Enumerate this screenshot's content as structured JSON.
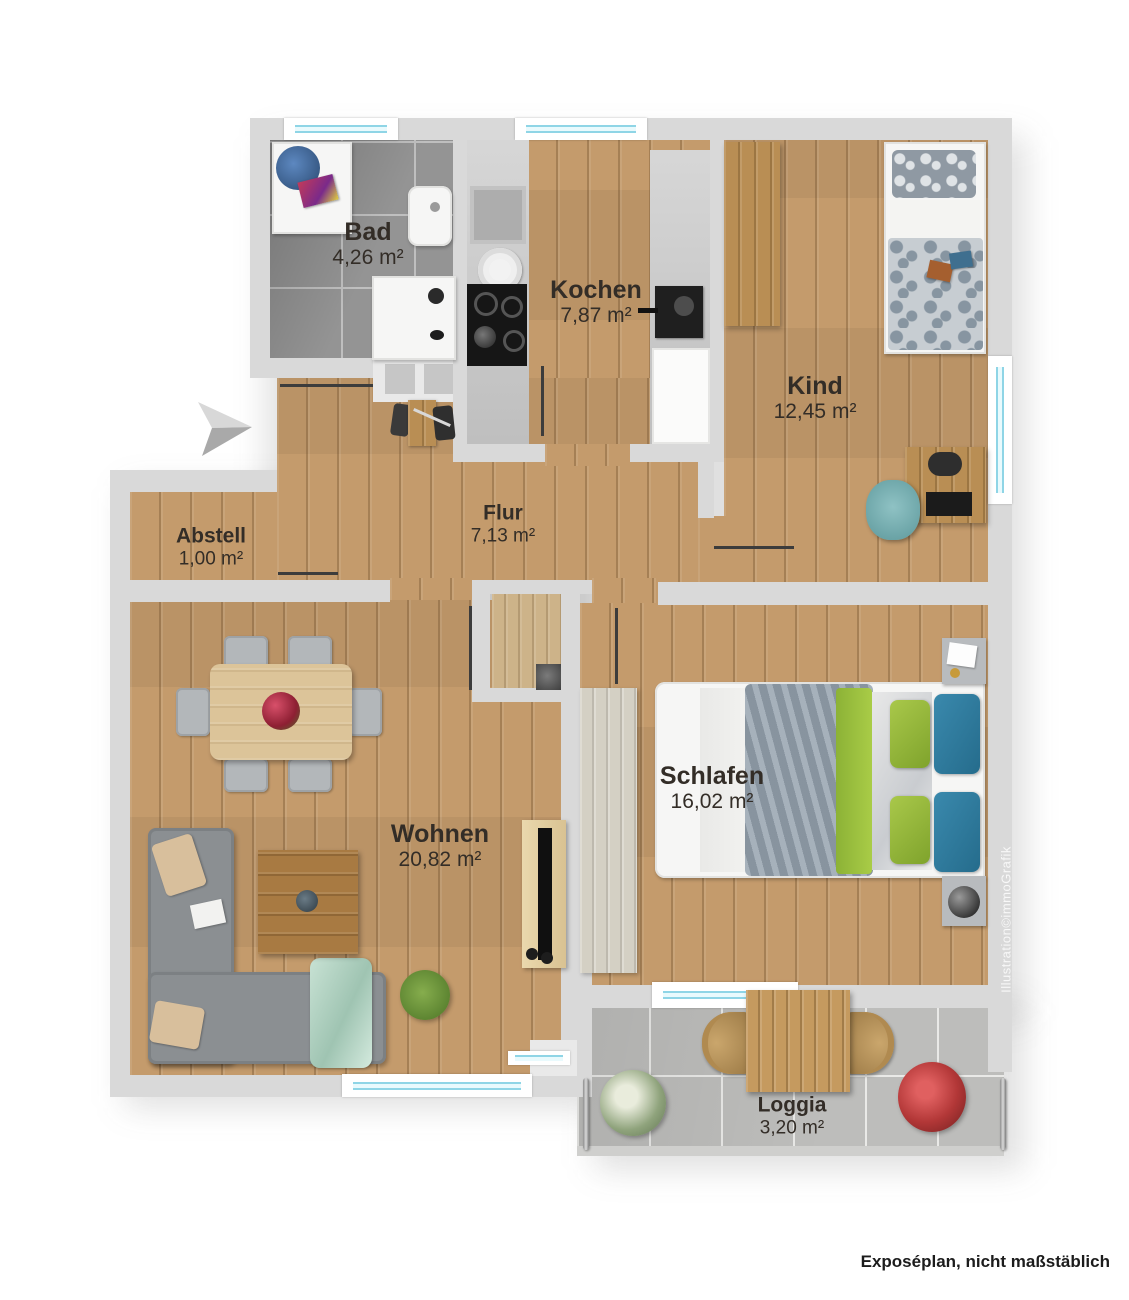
{
  "plan": {
    "rooms": [
      {
        "name": "Bad",
        "area": "4,26 m²"
      },
      {
        "name": "Kochen",
        "area": "7,87 m²"
      },
      {
        "name": "Kind",
        "area": "12,45 m²"
      },
      {
        "name": "Abstell",
        "area": "1,00 m²"
      },
      {
        "name": "Flur",
        "area": "7,13 m²"
      },
      {
        "name": "Wohnen",
        "area": "20,82 m²"
      },
      {
        "name": "Schlafen",
        "area": "16,02 m²"
      },
      {
        "name": "Loggia",
        "area": "3,20 m²"
      }
    ],
    "caption": "Exposéplan, nicht maßstäblich",
    "watermark": "Illustration©immoGrafik",
    "colors": {
      "wall": "#d9d9d9",
      "wood_floor": "#c49b6c",
      "bath_tile": "#949494",
      "loggia_tile": "#bdbdbb",
      "window_glass": "#8fd5e6",
      "label_text": "#332d27",
      "accent_green": "#9fbf3b",
      "accent_blue": "#2f7fa3"
    }
  }
}
